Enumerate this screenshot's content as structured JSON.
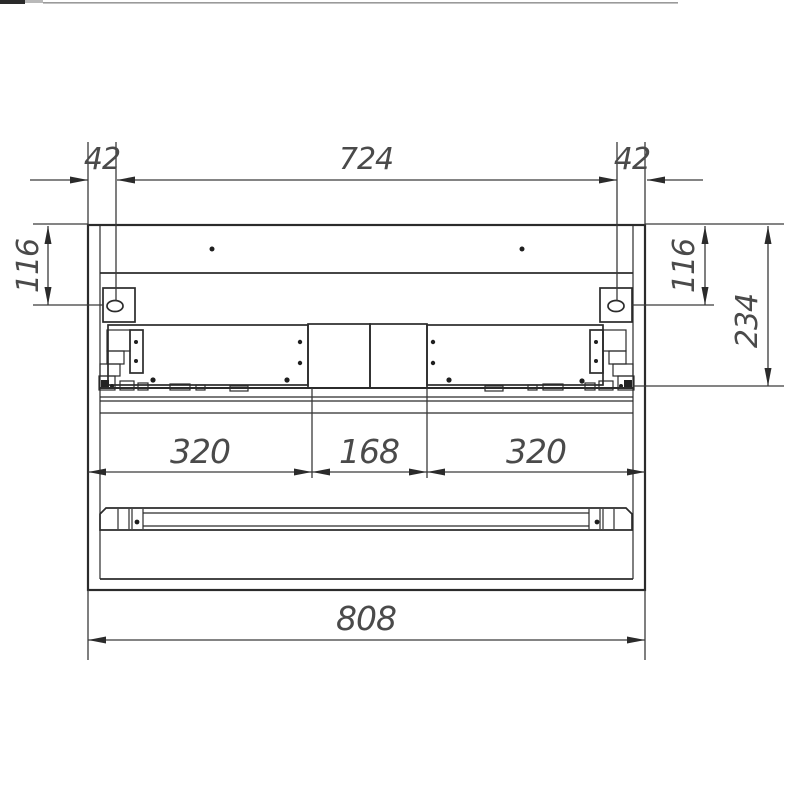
{
  "drawing": {
    "line_color": "#2b2b2b",
    "text_color": "#4a4a4a",
    "background_color": "#ffffff",
    "dimensions": {
      "top_left_offset": "42",
      "top_center_span": "724",
      "top_right_offset": "42",
      "left_hole_height": "116",
      "right_hole_height": "116",
      "right_side_depth": "234",
      "bottom_left_segment": "320",
      "bottom_center_segment": "168",
      "bottom_right_segment": "320",
      "overall_width": "808"
    }
  }
}
